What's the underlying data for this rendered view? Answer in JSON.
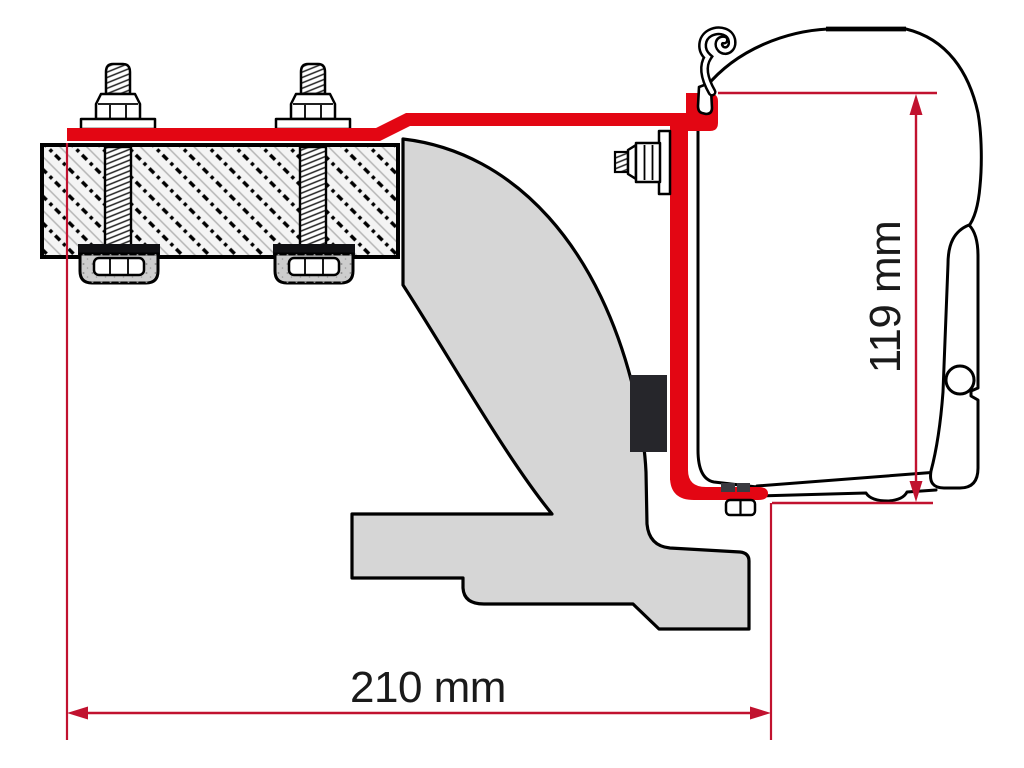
{
  "dimensions": {
    "width": {
      "label": "210 mm",
      "orientation": "horizontal"
    },
    "height": {
      "label": "119 mm",
      "orientation": "vertical"
    }
  },
  "colors": {
    "bracket_red": "#e30613",
    "dimension_red": "#c1122f",
    "body_gray": "#d6d6d6",
    "block_gray": "#cdcdcd",
    "spacer_black": "#26262b",
    "tab_gray": "#3a3a40",
    "outline_black": "#000000",
    "text_black": "#1a1a1a",
    "background": "#ffffff"
  }
}
